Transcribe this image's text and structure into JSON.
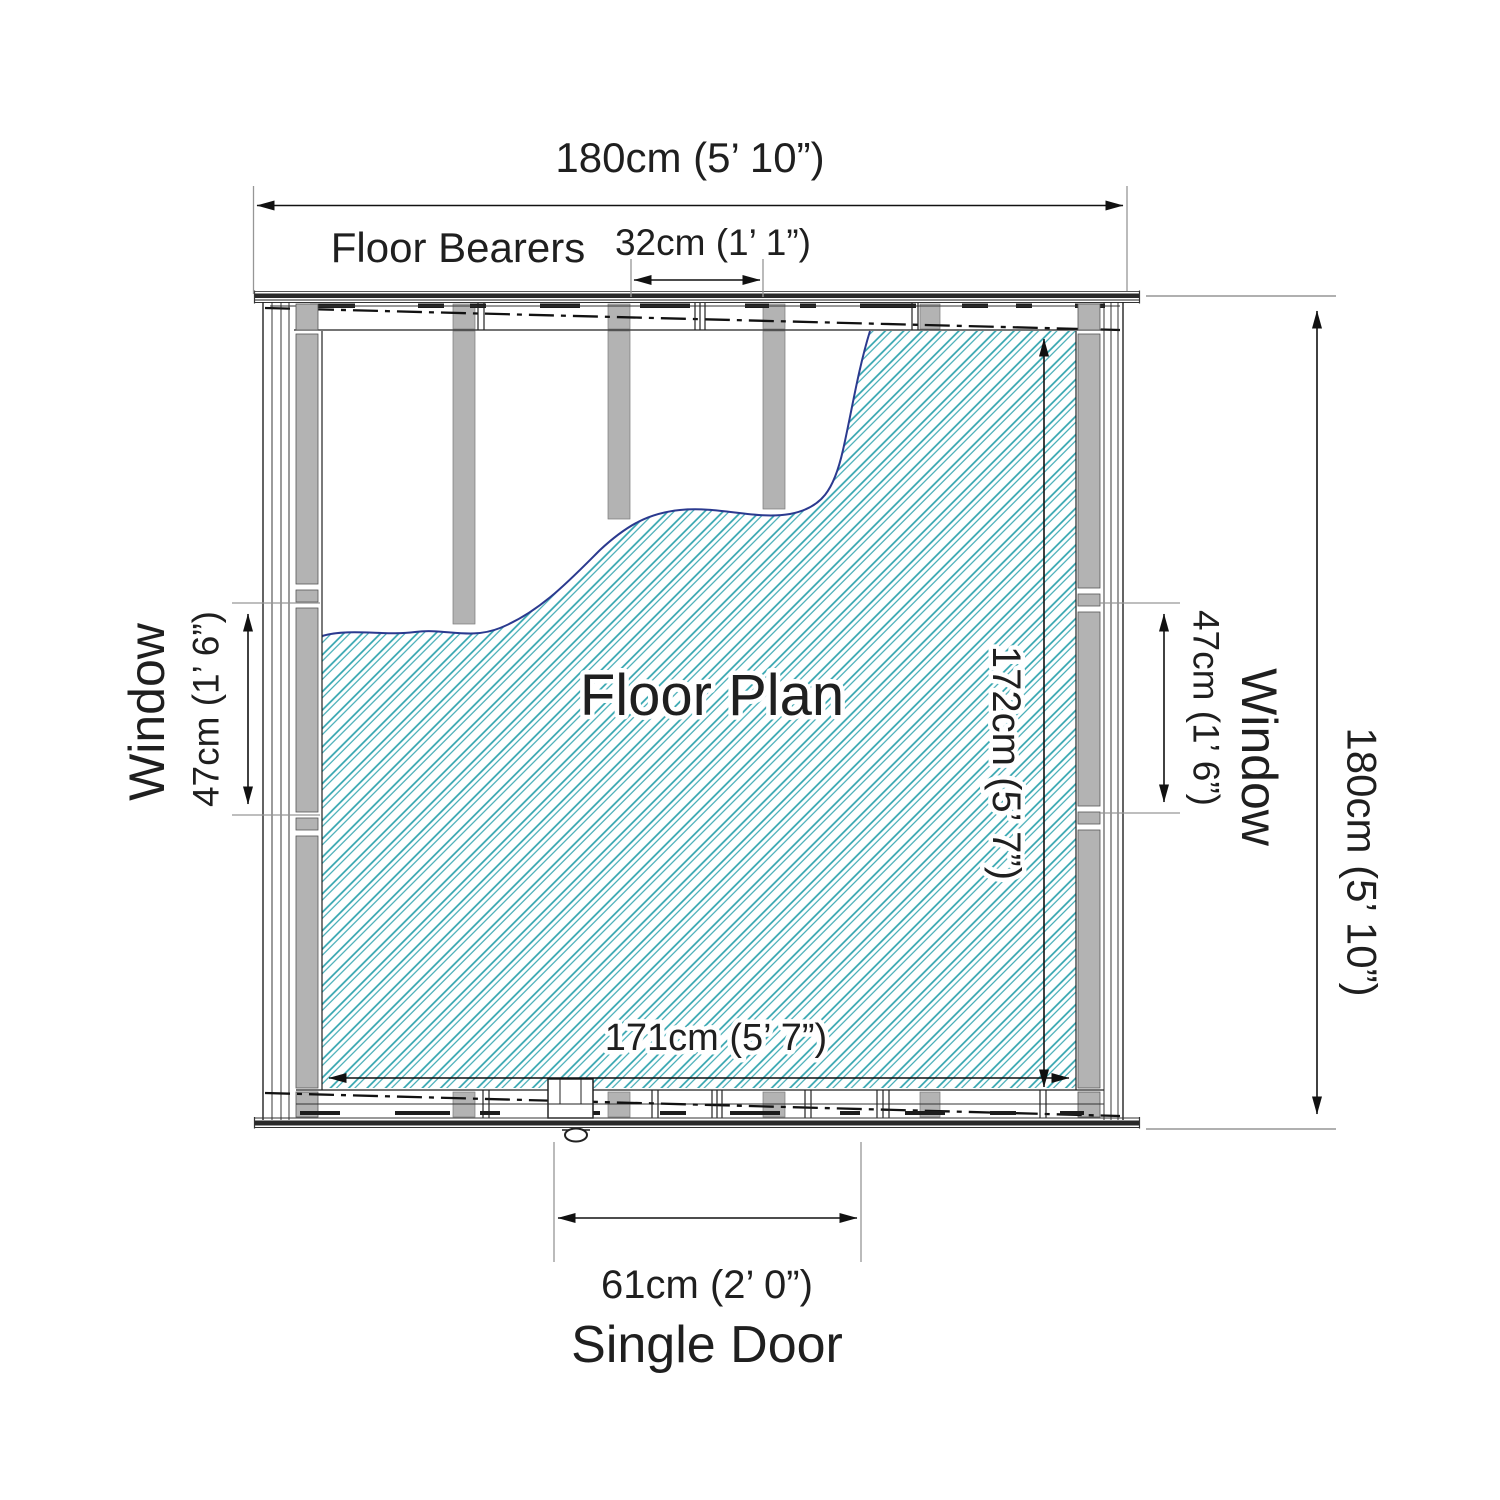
{
  "floor_plan": {
    "center_label": "Floor Plan",
    "overall": {
      "width": "180cm (5’ 10”)",
      "depth": "180cm (5’ 10”)"
    },
    "internal": {
      "width": "171cm (5’ 7”)",
      "depth": "172cm (5’ 7”)"
    },
    "floor_bearers": {
      "label": "Floor Bearers",
      "spacing": "32cm (1’ 1”)"
    },
    "windows": {
      "left": {
        "label": "Window",
        "size": "47cm (1’ 6”)"
      },
      "right": {
        "label": "Window",
        "size": "47cm (1’ 6”)"
      }
    },
    "door": {
      "label": "Single Door",
      "size": "61cm (2’ 0”)"
    },
    "colors": {
      "hatch_teal": "#2FA3AE",
      "tear_edge_navy": "#2B3A8F",
      "bearer_gray": "#B3B3B3",
      "line_dark": "#1A1A1A",
      "dim_line": "#111111",
      "ext_line": "#969696"
    }
  }
}
